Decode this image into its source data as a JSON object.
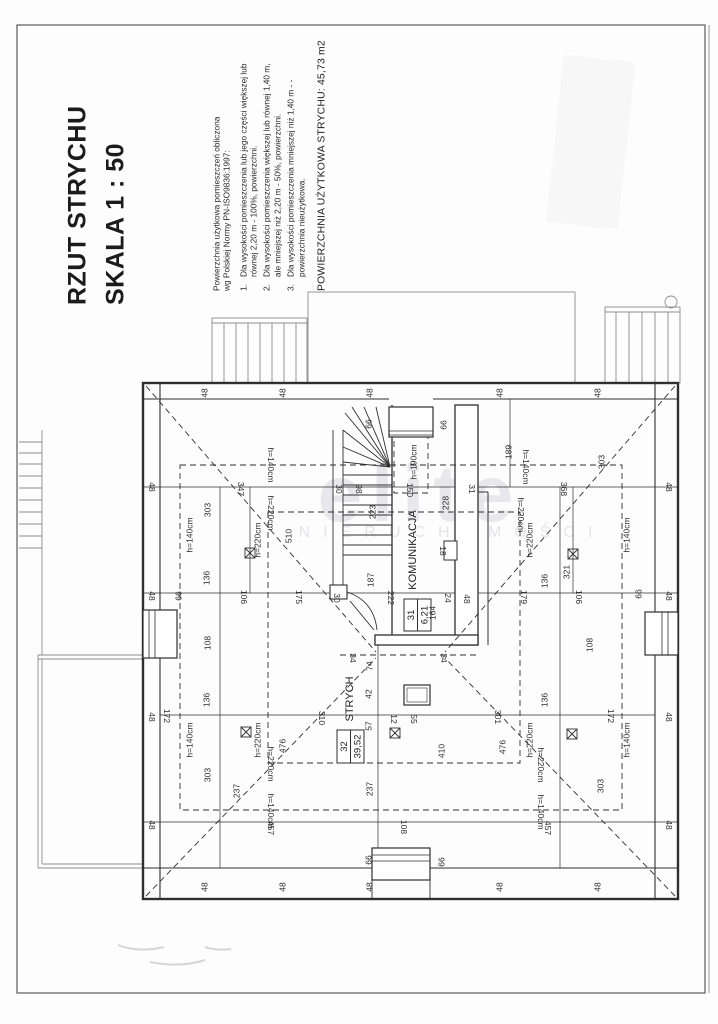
{
  "document": {
    "title_line1": "RZUT STRYCHU",
    "title_line2": "SKALA  1 : 50",
    "legend": {
      "intro": "Powierzchnia użytkowa pomieszczeń obliczona\nwg Polskiej Normy PN-ISO9836:1997:",
      "items": [
        {
          "n": "1.",
          "t": "Dla wysokości pomieszczenia lub jego części większej lub równej 2,20 m - 100%, powierzchni."
        },
        {
          "n": "2.",
          "t": "Dla wysokości pomieszczenia większej lub równej 1,40 m, ale mniejszej niż 2,20 m - 50%, powierzchni."
        },
        {
          "n": "3.",
          "t": "Dla wysokości pomieszczenia mniejszej niż 1,40 m - - powierzchnia nieużytkowa."
        }
      ],
      "total_area_label": "POWIERZCHNIA UŻYTKOWA STRYCHU: 45,73 m2"
    },
    "watermark": {
      "brand": "elite",
      "subtitle": "NIERUCHOMOŚCI"
    }
  },
  "rooms": [
    {
      "number": "31",
      "name": "KOMUNIKACJA",
      "area_m2": "6,21"
    },
    {
      "number": "32",
      "name": "STRYCH",
      "area_m2": "39,52"
    }
  ],
  "plan": {
    "scale": "1:50",
    "height_lines": [
      "h=140cm",
      "h=220cm",
      "h=190cm"
    ],
    "labels": [
      {
        "t": "48",
        "x": 205,
        "y": 393,
        "r": -90
      },
      {
        "t": "48",
        "x": 283,
        "y": 393,
        "r": -90
      },
      {
        "t": "48",
        "x": 370,
        "y": 393,
        "r": -90
      },
      {
        "t": "48",
        "x": 500,
        "y": 393,
        "r": -90
      },
      {
        "t": "48",
        "x": 598,
        "y": 393,
        "r": -90
      },
      {
        "t": "48",
        "x": 205,
        "y": 887,
        "r": -90
      },
      {
        "t": "48",
        "x": 283,
        "y": 887,
        "r": -90
      },
      {
        "t": "48",
        "x": 370,
        "y": 887,
        "r": -90
      },
      {
        "t": "48",
        "x": 500,
        "y": 887,
        "r": -90
      },
      {
        "t": "48",
        "x": 598,
        "y": 887,
        "r": -90
      },
      {
        "t": "48",
        "x": 151,
        "y": 487,
        "r": 90
      },
      {
        "t": "48",
        "x": 151,
        "y": 596,
        "r": 90
      },
      {
        "t": "48",
        "x": 151,
        "y": 717,
        "r": 90
      },
      {
        "t": "48",
        "x": 151,
        "y": 825,
        "r": 90
      },
      {
        "t": "48",
        "x": 668,
        "y": 487,
        "r": 90
      },
      {
        "t": "48",
        "x": 668,
        "y": 596,
        "r": 90
      },
      {
        "t": "48",
        "x": 668,
        "y": 717,
        "r": 90
      },
      {
        "t": "48",
        "x": 668,
        "y": 825,
        "r": 90
      },
      {
        "t": "66",
        "x": 369,
        "y": 424,
        "r": -90
      },
      {
        "t": "66",
        "x": 444,
        "y": 425,
        "r": -90
      },
      {
        "t": "66",
        "x": 369,
        "y": 860,
        "r": -90
      },
      {
        "t": "66",
        "x": 442,
        "y": 862,
        "r": -90
      },
      {
        "t": "66",
        "x": 179,
        "y": 596,
        "r": -90
      },
      {
        "t": "66",
        "x": 639,
        "y": 594,
        "r": -90
      },
      {
        "t": "189",
        "x": 509,
        "y": 452,
        "r": -90
      },
      {
        "t": "303",
        "x": 208,
        "y": 510,
        "r": -90
      },
      {
        "t": "303",
        "x": 602,
        "y": 462,
        "r": -90
      },
      {
        "t": "303",
        "x": 208,
        "y": 775,
        "r": -90
      },
      {
        "t": "303",
        "x": 601,
        "y": 786,
        "r": -90
      },
      {
        "t": "347",
        "x": 240,
        "y": 489,
        "r": 90
      },
      {
        "t": "368",
        "x": 563,
        "y": 489,
        "r": 90
      },
      {
        "t": "31",
        "x": 471,
        "y": 489,
        "r": 90
      },
      {
        "t": "30",
        "x": 338,
        "y": 489,
        "r": 90
      },
      {
        "t": "98",
        "x": 358,
        "y": 489,
        "r": 90
      },
      {
        "t": "150",
        "x": 409,
        "y": 490,
        "r": 90
      },
      {
        "t": "223",
        "x": 373,
        "y": 512,
        "r": -90
      },
      {
        "t": "228",
        "x": 446,
        "y": 503,
        "r": -90
      },
      {
        "t": "510",
        "x": 289,
        "y": 536,
        "r": -90
      },
      {
        "t": "321",
        "x": 567,
        "y": 572,
        "r": -90
      },
      {
        "t": "h=190cm",
        "x": 414,
        "y": 462,
        "r": -90,
        "s": 7.5
      },
      {
        "t": "h=140cm",
        "x": 190,
        "y": 535,
        "r": -90,
        "s": 7.5
      },
      {
        "t": "h=140cm",
        "x": 627,
        "y": 535,
        "r": -90,
        "s": 7.5
      },
      {
        "t": "h=140cm",
        "x": 190,
        "y": 740,
        "r": -90,
        "s": 7.5
      },
      {
        "t": "h=140cm",
        "x": 627,
        "y": 740,
        "r": -90,
        "s": 7.5
      },
      {
        "t": "h=220cm",
        "x": 258,
        "y": 540,
        "r": -90,
        "s": 7.5
      },
      {
        "t": "h=220cm",
        "x": 530,
        "y": 540,
        "r": -90,
        "s": 7.5
      },
      {
        "t": "h=220cm",
        "x": 258,
        "y": 740,
        "r": -90,
        "s": 7.5
      },
      {
        "t": "h=220cm",
        "x": 530,
        "y": 740,
        "r": -90,
        "s": 7.5
      },
      {
        "t": "h=140cm",
        "x": 270,
        "y": 465,
        "r": 90,
        "s": 7.5
      },
      {
        "t": "h=140cm",
        "x": 525,
        "y": 467,
        "r": 90,
        "s": 7.5
      },
      {
        "t": "h=140cm",
        "x": 270,
        "y": 811,
        "r": 90,
        "s": 7.5
      },
      {
        "t": "h=140cm",
        "x": 540,
        "y": 812,
        "r": 90,
        "s": 7.5
      },
      {
        "t": "h=220cm",
        "x": 270,
        "y": 513,
        "r": 90,
        "s": 7.5
      },
      {
        "t": "h=220cm",
        "x": 520,
        "y": 515,
        "r": 90,
        "s": 7.5
      },
      {
        "t": "h=220cm",
        "x": 270,
        "y": 764,
        "r": 90,
        "s": 7.5
      },
      {
        "t": "h=220cm",
        "x": 540,
        "y": 765,
        "r": 90,
        "s": 7.5
      },
      {
        "t": "136",
        "x": 207,
        "y": 578,
        "r": -90
      },
      {
        "t": "136",
        "x": 545,
        "y": 581,
        "r": -90
      },
      {
        "t": "136",
        "x": 207,
        "y": 700,
        "r": -90
      },
      {
        "t": "136",
        "x": 545,
        "y": 700,
        "r": -90
      },
      {
        "t": "108",
        "x": 208,
        "y": 643,
        "r": -90
      },
      {
        "t": "108",
        "x": 590,
        "y": 645,
        "r": -90
      },
      {
        "t": "108",
        "x": 403,
        "y": 827,
        "r": 90
      },
      {
        "t": "172",
        "x": 166,
        "y": 716,
        "r": 90
      },
      {
        "t": "172",
        "x": 610,
        "y": 716,
        "r": 90
      },
      {
        "t": "106",
        "x": 243,
        "y": 597,
        "r": 90
      },
      {
        "t": "106",
        "x": 578,
        "y": 597,
        "r": 90
      },
      {
        "t": "175",
        "x": 298,
        "y": 597,
        "r": 90
      },
      {
        "t": "179",
        "x": 523,
        "y": 597,
        "r": 90
      },
      {
        "t": "30",
        "x": 336,
        "y": 598,
        "r": 90
      },
      {
        "t": "187",
        "x": 371,
        "y": 580,
        "r": -90
      },
      {
        "t": "222",
        "x": 390,
        "y": 598,
        "r": 90
      },
      {
        "t": "18",
        "x": 442,
        "y": 551,
        "r": 90
      },
      {
        "t": "24",
        "x": 447,
        "y": 598,
        "r": 90
      },
      {
        "t": "48",
        "x": 466,
        "y": 599,
        "r": 90
      },
      {
        "t": "164",
        "x": 433,
        "y": 613,
        "r": -90
      },
      {
        "t": "34",
        "x": 352,
        "y": 658,
        "r": 90
      },
      {
        "t": "34",
        "x": 443,
        "y": 658,
        "r": 90
      },
      {
        "t": "476",
        "x": 283,
        "y": 746,
        "r": -90
      },
      {
        "t": "476",
        "x": 503,
        "y": 747,
        "r": -90
      },
      {
        "t": "410",
        "x": 442,
        "y": 751,
        "r": -90
      },
      {
        "t": "237",
        "x": 237,
        "y": 791,
        "r": -90
      },
      {
        "t": "237",
        "x": 370,
        "y": 789,
        "r": -90
      },
      {
        "t": "310",
        "x": 321,
        "y": 718,
        "r": 90
      },
      {
        "t": "301",
        "x": 497,
        "y": 717,
        "r": 90
      },
      {
        "t": "457",
        "x": 270,
        "y": 828,
        "r": 90
      },
      {
        "t": "457",
        "x": 547,
        "y": 828,
        "r": 90
      },
      {
        "t": "74",
        "x": 370,
        "y": 666,
        "r": -90
      },
      {
        "t": "42",
        "x": 369,
        "y": 694,
        "r": -90
      },
      {
        "t": "57",
        "x": 369,
        "y": 726,
        "r": -90
      },
      {
        "t": "12",
        "x": 393,
        "y": 719,
        "r": 90
      },
      {
        "t": "55",
        "x": 413,
        "y": 719,
        "r": 90
      }
    ]
  }
}
